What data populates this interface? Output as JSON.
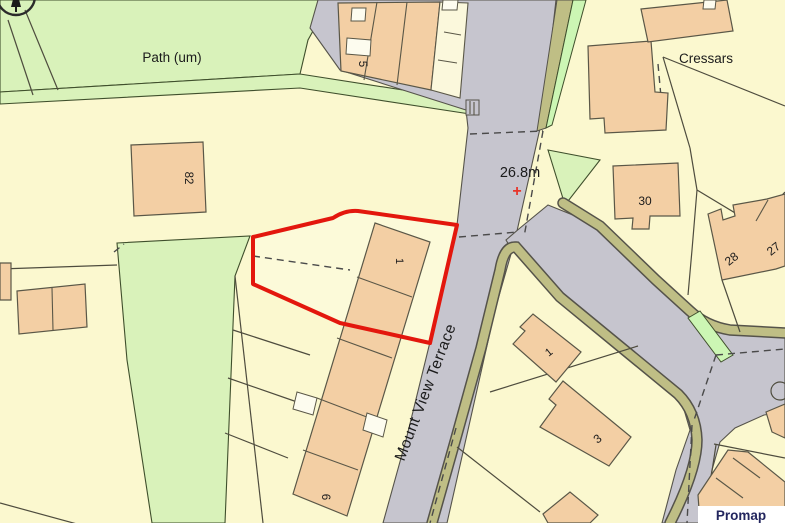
{
  "map": {
    "type": "os-site-plan",
    "labels": {
      "path": "Path (um)",
      "area": "Cressars",
      "road": "Mount View Terrace",
      "benchmark": "26.8m",
      "benchmark_symbol": "+"
    },
    "building_numbers": {
      "n82": "82",
      "n5": "5",
      "n30": "30",
      "n28": "28",
      "n27": "27",
      "n1_site": "1",
      "n1": "1",
      "n3": "3",
      "n6": "6"
    },
    "watermark": "Promap",
    "colors": {
      "background": "#FBF8CF",
      "grass": "#D9F2BA",
      "grass_light": "#CCF6B4",
      "building": "#F3CFA4",
      "building_pale": "#FBF8DC",
      "road": "#C6C5CE",
      "verge": "#BFBE85",
      "site_boundary_red": "#E3170D",
      "benchmark_red": "#E8352A",
      "promap_navy": "#23265E"
    }
  }
}
